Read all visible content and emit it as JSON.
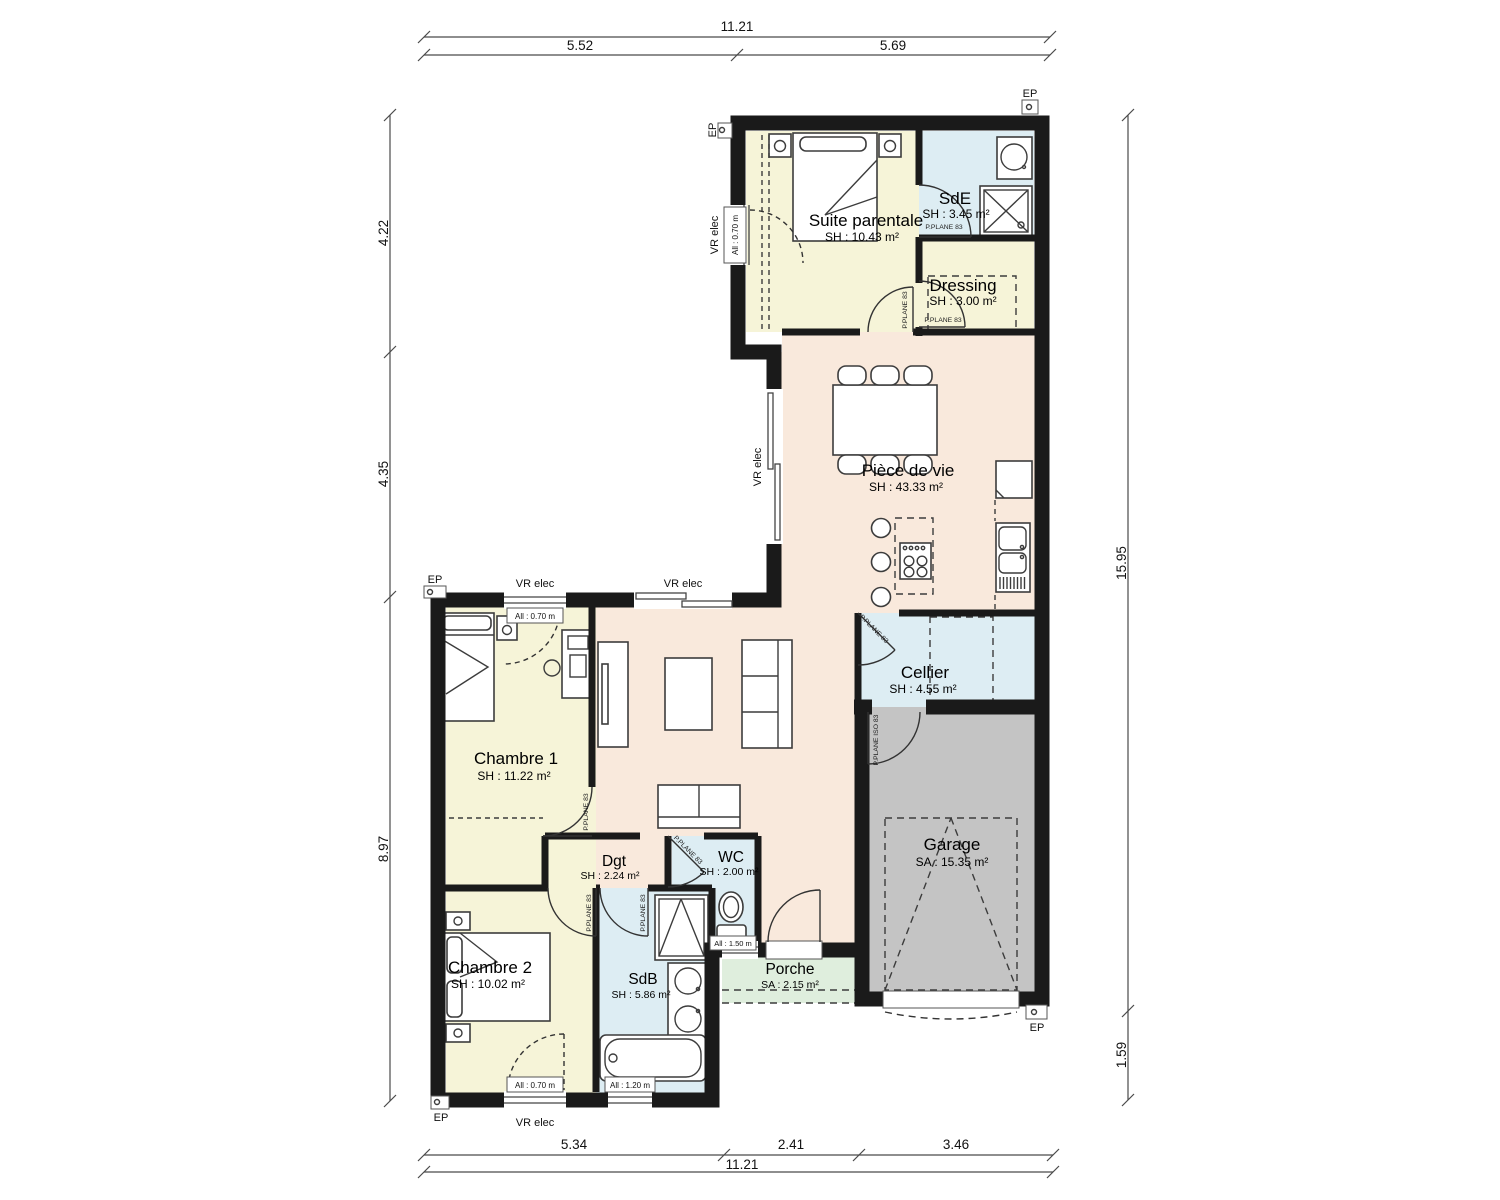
{
  "rooms": {
    "suite": {
      "name": "Suite parentale",
      "area": "SH : 10.43 m²"
    },
    "sde": {
      "name": "SdE",
      "area": "SH : 3.45 m²"
    },
    "dressing": {
      "name": "Dressing",
      "area": "SH : 3.00 m²"
    },
    "pdv": {
      "name": "Pièce de vie",
      "area": "SH : 43.33 m²"
    },
    "cellier": {
      "name": "Cellier",
      "area": "SH : 4.55 m²"
    },
    "garage": {
      "name": "Garage",
      "area": "SA : 15.35 m²"
    },
    "ch1": {
      "name": "Chambre 1",
      "area": "SH : 11.22 m²"
    },
    "dgt": {
      "name": "Dgt",
      "area": "SH : 2.24 m²"
    },
    "wc": {
      "name": "WC",
      "area": "SH : 2.00 m²"
    },
    "ch2": {
      "name": "Chambre 2",
      "area": "SH : 10.02 m²"
    },
    "sdb": {
      "name": "SdB",
      "area": "SH : 5.86 m²"
    },
    "porche": {
      "name": "Porche",
      "area": "SA : 2.15 m²"
    }
  },
  "dims": {
    "top_total": "11.21",
    "top_a": "5.52",
    "top_b": "5.69",
    "left_a": "4.22",
    "left_b": "4.35",
    "left_c": "8.97",
    "right_a": "15.95",
    "right_b": "1.59",
    "bottom_a": "5.34",
    "bottom_b": "2.41",
    "bottom_c": "3.46",
    "bottom_total": "11.21"
  },
  "labels": {
    "vr_elec": "VR elec",
    "all_070": "All : 0.70 m",
    "all_120": "All : 1.20 m",
    "all_150": "All : 1.50 m",
    "p_plane": "P.PLANE 83",
    "p_plane_iso": "P.PLANE ISO 83",
    "ep": "EP"
  },
  "colors": {
    "wall": "#1a1a1a",
    "bedroom": "#f6f4d8",
    "wet": "#ddedf3",
    "living": "#f9e9dc",
    "garage": "#c4c4c4",
    "porch": "#dfeedd",
    "line": "#3c3c3c",
    "dim": "#4a4a4a"
  }
}
